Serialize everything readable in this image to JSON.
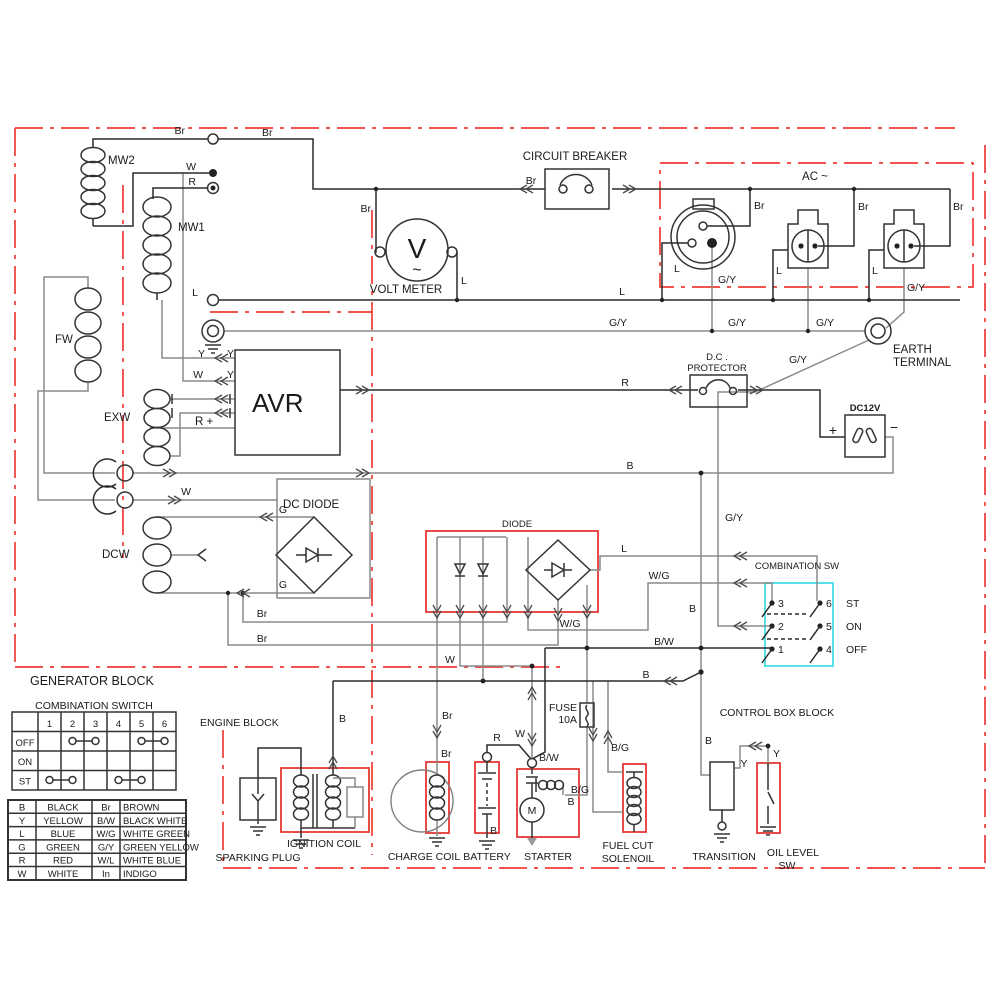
{
  "labels": {
    "generator_block": "GENERATOR BLOCK",
    "engine_block": "ENGINE BLOCK",
    "control_box_block": "CONTROL BOX BLOCK",
    "ac": "AC ~",
    "circuit_breaker": "CIRCUIT BREAKER",
    "volt_meter": "VOLT METER",
    "volt_v": "V",
    "volt_wave": "~",
    "earth_1": "EARTH",
    "earth_2": "TERMINAL",
    "dc_protector_1": "D.C .",
    "dc_protector_2": "PROTECTOR",
    "dc12v": "DC12V",
    "plus": "+",
    "minus": "−",
    "dc_diode": "DC DIODE",
    "diode": "DIODE",
    "combination_sw": "COMBINATION SW",
    "avr": "AVR",
    "r_plus": "R +",
    "mw2": "MW2",
    "mw1": "MW1",
    "fw": "FW",
    "exw": "EXW",
    "dcw": "DCW",
    "st": "ST",
    "on": "ON",
    "off": "OFF",
    "sparking_plug": "SPARKING PLUG",
    "ignition_coil": "IGNITION COIL",
    "charge_coil": "CHARGE COIL",
    "battery": "BATTERY",
    "starter": "STARTER",
    "motor_m": "M",
    "fuse_1": "FUSE",
    "fuse_2": "10A",
    "fuel_cut_1": "FUEL CUT",
    "fuel_cut_2": "SOLENOIL",
    "transition": "TRANSITION",
    "oil_level_1": "OIL LEVEL",
    "oil_level_2": "SW"
  },
  "contacts": [
    "1",
    "2",
    "3",
    "4",
    "5",
    "6"
  ],
  "switch_table": {
    "title": "COMBINATION SWITCH",
    "rows": [
      "OFF",
      "ON",
      "ST"
    ],
    "links": {
      "OFF": [
        [
          2,
          3
        ],
        [
          5,
          6
        ]
      ],
      "ON": [],
      "ST": [
        [
          1,
          2
        ],
        [
          4,
          5
        ]
      ]
    }
  },
  "legend": {
    "rows": [
      [
        "B",
        "BLACK",
        "Br",
        "BROWN"
      ],
      [
        "Y",
        "YELLOW",
        "B/W",
        "BLACK WHITE"
      ],
      [
        "L",
        "BLUE",
        "W/G",
        "WHITE GREEN"
      ],
      [
        "G",
        "GREEN",
        "G/Y",
        "GREEN YELLOW"
      ],
      [
        "R",
        "RED",
        "W/L",
        "WHITE BLUE"
      ],
      [
        "W",
        "WHITE",
        "In",
        "INDIGO"
      ]
    ]
  },
  "wires": {
    "br_top_left": "Br",
    "br_top_right": "Br",
    "br_voltmeter": "Br",
    "br_breaker": "Br",
    "br_outlet1": "Br",
    "br_outlet2": "Br",
    "br_outlet3": "Br",
    "w_mw": "W",
    "r_mw": "R",
    "l_mw": "L",
    "l_voltmeter": "L",
    "l_bus": "L",
    "l_outlet1": "L",
    "l_outlet2": "L",
    "l_outlet3": "L",
    "gy_outlet1": "G/Y",
    "gy_outlet3": "G/Y",
    "gy_bus1": "G/Y",
    "gy_bus2": "G/Y",
    "gy_bus3": "G/Y",
    "gy_earth": "G/Y",
    "gy_vert": "G/Y",
    "y_left": "Y",
    "y_right": "Y",
    "w_avr": "W",
    "y_avr": "Y",
    "r_protector": "R",
    "b_bus": "B",
    "w_rings": "W",
    "g_upper": "G",
    "g_lower": "G",
    "br_1": "Br",
    "br_2": "Br",
    "l_comb": "L",
    "wg_comb": "W/G",
    "wg_diode": "W/G",
    "b_comb": "B",
    "bw_comb": "B/W",
    "w_diode": "W",
    "w_starter": "W",
    "b_engine": "B",
    "b_ignition": "B",
    "br_charge1": "Br",
    "br_charge2": "Br",
    "r_battery": "R",
    "bw_starter": "B/W",
    "b_starter": "B",
    "b_battery": "B",
    "bg_1": "B/G",
    "bg_2": "B/G",
    "b_transition": "B",
    "y_transition": "Y",
    "y_oil": "Y"
  },
  "colors": {
    "highlight_red": "#e53935",
    "highlight_cyan": "#45dde8",
    "wire_black": "#2a2a2a",
    "wire_gray": "#8a8a8a",
    "background": "#ffffff"
  }
}
